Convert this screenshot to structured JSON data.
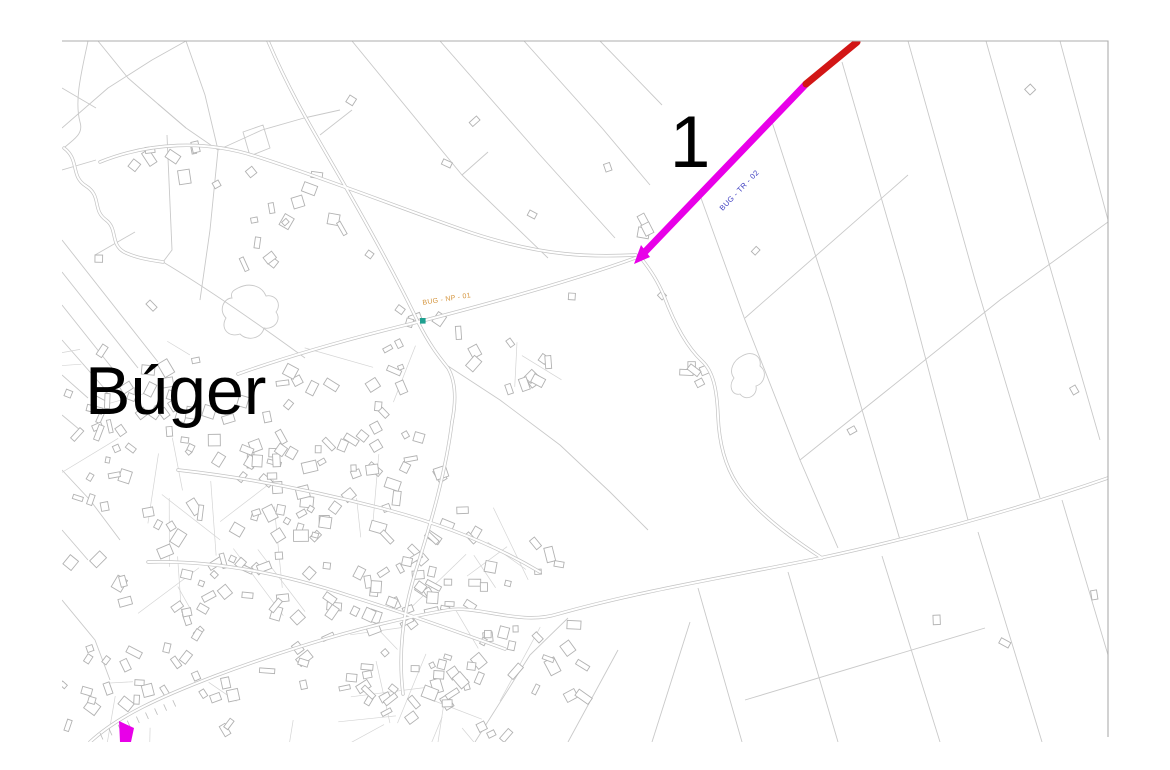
{
  "map": {
    "town_label": "Búger",
    "zone_label": "1",
    "route_label": "BUG - TR - 02",
    "np_label": "BUG - NP - 01"
  },
  "colors": {
    "route_main": "#e800e8",
    "route_alt": "#d21616",
    "route_label_color": "#3b3bc0",
    "np_label_color": "#d4943c",
    "marker": "#1fa090",
    "marker_border": "#127a6e"
  }
}
